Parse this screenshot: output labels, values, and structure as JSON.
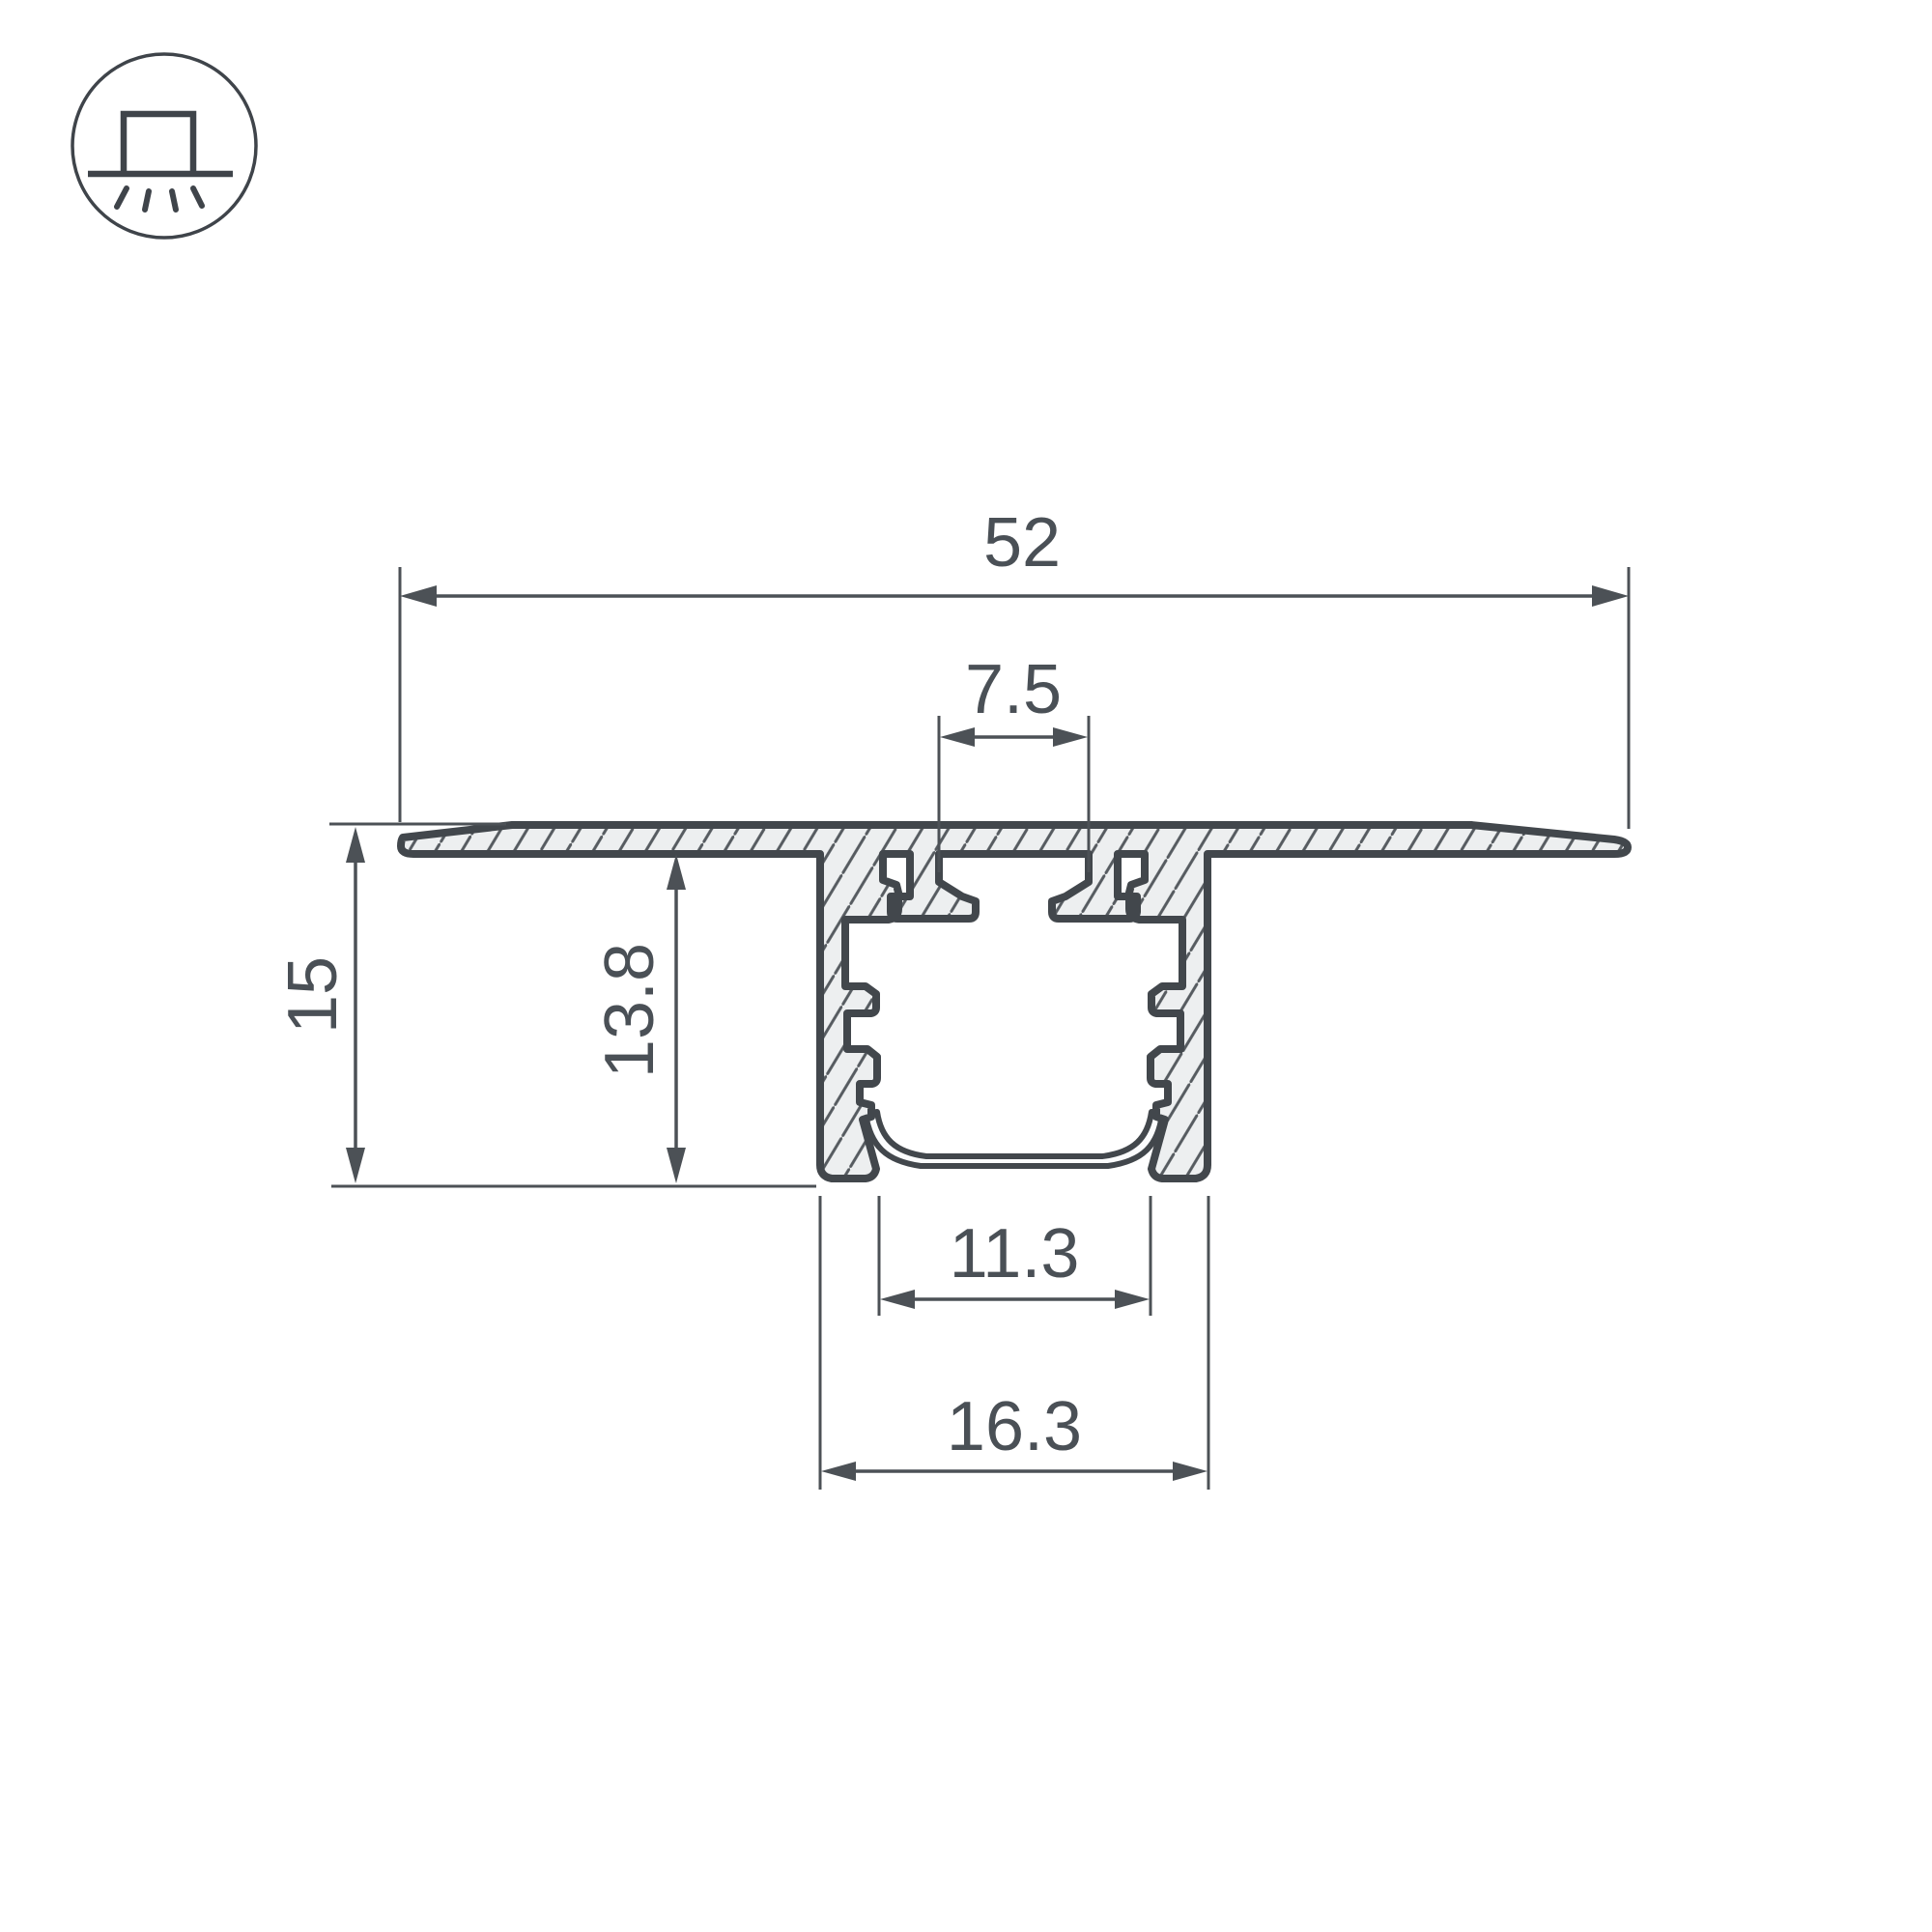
{
  "drawing": {
    "type": "led-aluminium-profile-cross-section",
    "icon": "recessed-mount-luminaire-icon",
    "dimensions": {
      "overall_width": "52",
      "top_screw_slot_width": "7.5",
      "overall_height": "15",
      "recess_depth": "13.8",
      "inner_opening_width": "11.3",
      "channel_body_width": "16.3"
    },
    "colors": {
      "background": "#ffffff",
      "outline": "#42474c",
      "metal_fill": "#edeff0",
      "hatch_line": "#565b60",
      "dimension_line": "#4c5156",
      "label_text": "#4a5056"
    }
  }
}
